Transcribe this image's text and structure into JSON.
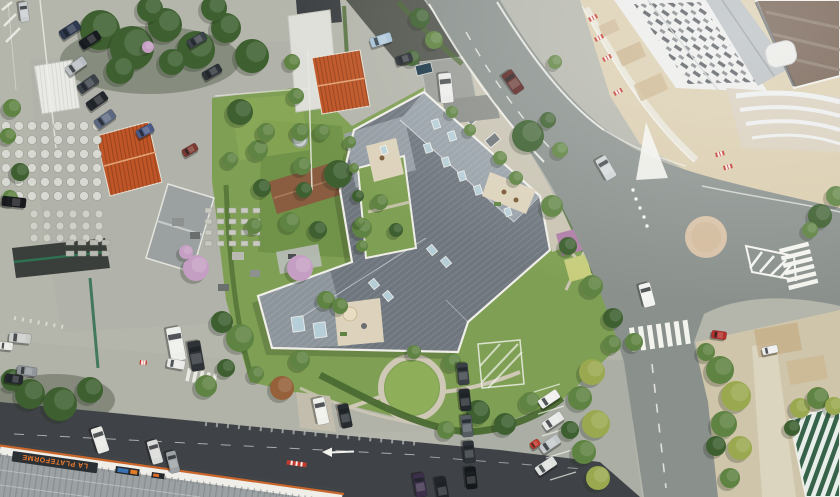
{
  "canvas": {
    "width": 840,
    "height": 497
  },
  "signs": {
    "la_plateforme": "LA PLATEFORME"
  },
  "palette": {
    "base": "#b4b5ab",
    "concrete": "#c0c1b8",
    "yard": "#b0b1a8",
    "asphalt": "#8a918d",
    "road_dark": "#3f4347",
    "sand": "#dacdae",
    "dirt": "#c4ab83",
    "gravel": "#cfc5ab",
    "path_light": "#ddd6c2",
    "grass": "#7fa054",
    "lawn": "#8fae5a",
    "hedge": "#4a6a32",
    "grass_dark": "#6f9148",
    "roof_dark": "#6f767e",
    "roof_light": "#99a2a9",
    "roof_mid": "#8d959c",
    "parapet": "#efeee8",
    "terrace": "#ddd3bc",
    "path_stone": "#cfc8b6",
    "courtyard_path": "#c9c4b3",
    "red_roof": "#c05627",
    "brown_house": "#8a5c40",
    "warehouse": "#9ba1a1",
    "white_roof": "#ebecea",
    "vent": "#343a40",
    "brown_roof": "#6e594a",
    "roundabout": "#d8c2a7",
    "marking": "#f4f4ef",
    "lp_roof": "#9ca2a4",
    "sign_band": "#2b3035",
    "sign_text": "#ee7b2d",
    "lp_stripe": "#c8662c",
    "stripe_green": "#37634a",
    "roof_slope": "#b6bcbf",
    "barrier_red": "#c23b2e",
    "glass": "#b9d2dc",
    "water": "#1f3a4a",
    "bed_pink": "#b07fa8",
    "bed_lime": "#c7cd7c",
    "bed_green": "#90ab56",
    "parking": "#abaea5"
  },
  "tree_colors": {
    "dark": "#3e6030",
    "mid": "#5f8342",
    "yellow": "#9aa94f",
    "pink": "#c49fc3",
    "rust": "#96603a"
  },
  "trees": [
    [
      100,
      30,
      20,
      "dark"
    ],
    [
      132,
      48,
      22,
      "dark"
    ],
    [
      165,
      25,
      17,
      "dark"
    ],
    [
      196,
      50,
      19,
      "dark"
    ],
    [
      226,
      28,
      15,
      "dark"
    ],
    [
      252,
      56,
      17,
      "dark"
    ],
    [
      214,
      8,
      13,
      "dark"
    ],
    [
      150,
      9,
      13,
      "dark"
    ],
    [
      120,
      70,
      14,
      "dark"
    ],
    [
      172,
      62,
      13,
      "dark"
    ],
    [
      148,
      47,
      6,
      "pink"
    ],
    [
      292,
      62,
      8,
      "mid"
    ],
    [
      296,
      96,
      8,
      "mid"
    ],
    [
      300,
      132,
      9,
      "mid"
    ],
    [
      302,
      166,
      9,
      "mid"
    ],
    [
      304,
      190,
      8,
      "dark"
    ],
    [
      12,
      108,
      9,
      "mid"
    ],
    [
      8,
      136,
      8,
      "mid"
    ],
    [
      20,
      172,
      9,
      "dark"
    ],
    [
      10,
      198,
      8,
      "mid"
    ],
    [
      196,
      268,
      13,
      "pink"
    ],
    [
      186,
      252,
      7,
      "pink"
    ],
    [
      258,
      150,
      10,
      "mid"
    ],
    [
      262,
      188,
      9,
      "dark"
    ],
    [
      322,
      132,
      8,
      "mid"
    ],
    [
      290,
      222,
      10,
      "mid"
    ],
    [
      318,
      230,
      9,
      "dark"
    ],
    [
      254,
      226,
      8,
      "mid"
    ],
    [
      240,
      112,
      13,
      "dark"
    ],
    [
      266,
      132,
      9,
      "mid"
    ],
    [
      230,
      160,
      8,
      "mid"
    ],
    [
      338,
      174,
      14,
      "dark"
    ],
    [
      362,
      228,
      10,
      "mid"
    ],
    [
      380,
      202,
      8,
      "mid"
    ],
    [
      396,
      230,
      7,
      "dark"
    ],
    [
      300,
      268,
      13,
      "pink"
    ],
    [
      326,
      300,
      9,
      "mid"
    ],
    [
      350,
      142,
      6,
      "mid"
    ],
    [
      354,
      168,
      5,
      "mid"
    ],
    [
      358,
      196,
      6,
      "dark"
    ],
    [
      360,
      222,
      5,
      "mid"
    ],
    [
      362,
      246,
      6,
      "mid"
    ],
    [
      452,
      112,
      6,
      "mid"
    ],
    [
      470,
      130,
      6,
      "mid"
    ],
    [
      500,
      158,
      7,
      "mid"
    ],
    [
      516,
      178,
      7,
      "mid"
    ],
    [
      528,
      136,
      16,
      "dark"
    ],
    [
      555,
      62,
      7,
      "mid"
    ],
    [
      420,
      18,
      10,
      "dark"
    ],
    [
      434,
      40,
      9,
      "mid"
    ],
    [
      412,
      58,
      8,
      "dark"
    ],
    [
      548,
      120,
      8,
      "dark"
    ],
    [
      560,
      150,
      8,
      "mid"
    ],
    [
      552,
      206,
      11,
      "mid"
    ],
    [
      568,
      246,
      9,
      "dark"
    ],
    [
      592,
      286,
      11,
      "mid"
    ],
    [
      613,
      318,
      10,
      "dark"
    ],
    [
      634,
      342,
      9,
      "mid"
    ],
    [
      240,
      338,
      14,
      "mid"
    ],
    [
      222,
      322,
      11,
      "dark"
    ],
    [
      282,
      388,
      12,
      "rust"
    ],
    [
      300,
      360,
      10,
      "mid"
    ],
    [
      340,
      306,
      8,
      "mid"
    ],
    [
      452,
      362,
      9,
      "mid"
    ],
    [
      478,
      412,
      12,
      "dark"
    ],
    [
      505,
      424,
      11,
      "dark"
    ],
    [
      530,
      402,
      10,
      "mid"
    ],
    [
      446,
      430,
      9,
      "mid"
    ],
    [
      414,
      352,
      7,
      "mid"
    ],
    [
      30,
      394,
      15,
      "dark"
    ],
    [
      60,
      404,
      17,
      "dark"
    ],
    [
      90,
      390,
      13,
      "dark"
    ],
    [
      12,
      380,
      11,
      "dark"
    ],
    [
      206,
      386,
      11,
      "mid"
    ],
    [
      226,
      368,
      9,
      "dark"
    ],
    [
      256,
      374,
      8,
      "mid"
    ],
    [
      592,
      372,
      13,
      "yellow"
    ],
    [
      580,
      398,
      12,
      "mid"
    ],
    [
      596,
      424,
      14,
      "yellow"
    ],
    [
      584,
      452,
      12,
      "mid"
    ],
    [
      598,
      478,
      12,
      "yellow"
    ],
    [
      612,
      344,
      9,
      "mid"
    ],
    [
      570,
      430,
      9,
      "dark"
    ],
    [
      720,
      370,
      14,
      "mid"
    ],
    [
      736,
      396,
      15,
      "yellow"
    ],
    [
      724,
      424,
      13,
      "mid"
    ],
    [
      740,
      448,
      12,
      "yellow"
    ],
    [
      716,
      446,
      10,
      "dark"
    ],
    [
      706,
      352,
      9,
      "mid"
    ],
    [
      730,
      478,
      10,
      "mid"
    ],
    [
      800,
      408,
      10,
      "yellow"
    ],
    [
      818,
      398,
      11,
      "mid"
    ],
    [
      834,
      406,
      9,
      "yellow"
    ],
    [
      792,
      428,
      8,
      "dark"
    ],
    [
      820,
      216,
      12,
      "dark"
    ],
    [
      836,
      196,
      10,
      "mid"
    ],
    [
      810,
      230,
      8,
      "mid"
    ]
  ],
  "cars": [
    [
      24,
      12,
      20,
      9,
      82,
      "#c9cdd0"
    ],
    [
      70,
      30,
      22,
      10,
      -33,
      "#2e3950"
    ],
    [
      90,
      40,
      22,
      10,
      -33,
      "#171b20"
    ],
    [
      76,
      66,
      22,
      10,
      -35,
      "#b9bec2"
    ],
    [
      88,
      84,
      22,
      10,
      -35,
      "#3a4147"
    ],
    [
      97,
      101,
      22,
      10,
      -35,
      "#23282e"
    ],
    [
      105,
      119,
      22,
      10,
      -35,
      "#5b6880"
    ],
    [
      197,
      40,
      20,
      9,
      -30,
      "#3c4349"
    ],
    [
      212,
      72,
      20,
      9,
      -30,
      "#2c3237"
    ],
    [
      145,
      131,
      18,
      9,
      -28,
      "#4b5a86"
    ],
    [
      190,
      150,
      16,
      8,
      -30,
      "#7c3a30"
    ],
    [
      381,
      40,
      22,
      10,
      -18,
      "#a9c4d8"
    ],
    [
      404,
      59,
      17,
      9,
      -18,
      "#2b3036"
    ],
    [
      446,
      88,
      30,
      13,
      84,
      "#e9eae7"
    ],
    [
      513,
      82,
      24,
      12,
      55,
      "#5a2622"
    ],
    [
      14,
      202,
      24,
      10,
      6,
      "#17191d"
    ],
    [
      20,
      338,
      22,
      10,
      6,
      "#c9ccc9"
    ],
    [
      6,
      346,
      14,
      8,
      6,
      "#e8e8e4"
    ],
    [
      27,
      371,
      20,
      9,
      8,
      "#8f959a"
    ],
    [
      14,
      379,
      18,
      9,
      8,
      "#24282d"
    ],
    [
      176,
      344,
      34,
      15,
      80,
      "#edefeb"
    ],
    [
      196,
      356,
      30,
      13,
      80,
      "#2e3338"
    ],
    [
      321,
      411,
      27,
      12,
      78,
      "#eff0ec"
    ],
    [
      345,
      416,
      24,
      11,
      78,
      "#272c31"
    ],
    [
      647,
      295,
      24,
      12,
      75,
      "#f2f3f0"
    ],
    [
      606,
      168,
      24,
      12,
      60,
      "#cfd4d6"
    ],
    [
      719,
      335,
      15,
      8,
      8,
      "#b3302a"
    ],
    [
      549,
      399,
      22,
      10,
      -34,
      "#eff0ed"
    ],
    [
      553,
      421,
      22,
      10,
      -34,
      "#e6e8e6"
    ],
    [
      550,
      444,
      22,
      10,
      -34,
      "#c3c8ca"
    ],
    [
      546,
      466,
      22,
      10,
      -34,
      "#dfe1de"
    ],
    [
      535,
      444,
      10,
      7,
      -34,
      "#c0392b"
    ],
    [
      463,
      374,
      22,
      11,
      84,
      "#3a4046"
    ],
    [
      465,
      400,
      22,
      11,
      84,
      "#23282d"
    ],
    [
      467,
      426,
      22,
      11,
      84,
      "#555d63"
    ],
    [
      469,
      452,
      22,
      11,
      84,
      "#2d3338"
    ],
    [
      471,
      478,
      22,
      11,
      84,
      "#15181b"
    ],
    [
      100,
      440,
      26,
      12,
      72,
      "#e9eae6"
    ],
    [
      155,
      452,
      24,
      11,
      74,
      "#d9dbd8"
    ],
    [
      173,
      462,
      22,
      10,
      76,
      "#9ba1a5"
    ],
    [
      420,
      485,
      24,
      11,
      80,
      "#3b2f4a"
    ],
    [
      442,
      489,
      24,
      11,
      80,
      "#22262b"
    ],
    [
      176,
      364,
      18,
      9,
      10,
      "#e9eae7"
    ],
    [
      770,
      350,
      16,
      8,
      -12,
      "#eef0ee"
    ]
  ],
  "skylights": [
    [
      436,
      124,
      7,
      9,
      -18
    ],
    [
      452,
      136,
      7,
      9,
      -18
    ],
    [
      428,
      148,
      7,
      9,
      -18
    ],
    [
      446,
      162,
      7,
      9,
      -18
    ],
    [
      462,
      176,
      7,
      9,
      -18
    ],
    [
      478,
      190,
      7,
      9,
      -18
    ],
    [
      508,
      212,
      6,
      8,
      -18
    ],
    [
      432,
      250,
      7,
      9,
      -40
    ],
    [
      446,
      262,
      7,
      9,
      -40
    ],
    [
      374,
      284,
      7,
      9,
      -40
    ],
    [
      388,
      296,
      7,
      9,
      -40
    ],
    [
      384,
      150,
      6,
      8,
      -18
    ],
    [
      298,
      324,
      12,
      15,
      -8
    ],
    [
      320,
      330,
      12,
      15,
      -8
    ]
  ],
  "barriers": [
    [
      594,
      38,
      -28,
      9
    ],
    [
      602,
      58,
      -28,
      9
    ],
    [
      613,
      92,
      -28,
      9
    ],
    [
      715,
      153,
      -15,
      9
    ],
    [
      723,
      166,
      -15,
      9
    ],
    [
      140,
      360,
      5,
      7
    ],
    [
      588,
      18,
      -28,
      9
    ],
    [
      287,
      460,
      8,
      20
    ]
  ],
  "stacks": [
    {
      "x": 6,
      "y": 126,
      "cols": 8,
      "rows": 6,
      "gx": 13,
      "gy": 14,
      "r": 4.5,
      "c": "#d8d9d2"
    },
    {
      "x": 34,
      "y": 214,
      "cols": 6,
      "rows": 3,
      "gx": 13,
      "gy": 12,
      "r": 4,
      "c": "#cfd0c8"
    },
    {
      "x": 205,
      "y": 208,
      "cols": 5,
      "rows": 4,
      "gx": 12,
      "gy": 11,
      "r": 0,
      "w": 7,
      "h": 5,
      "c": "#c9cac2"
    },
    {
      "x": 66,
      "y": 240,
      "cols": 4,
      "rows": 2,
      "gx": 12,
      "gy": 11,
      "r": 0,
      "w": 8,
      "h": 5,
      "c": "#b9bab2"
    }
  ]
}
